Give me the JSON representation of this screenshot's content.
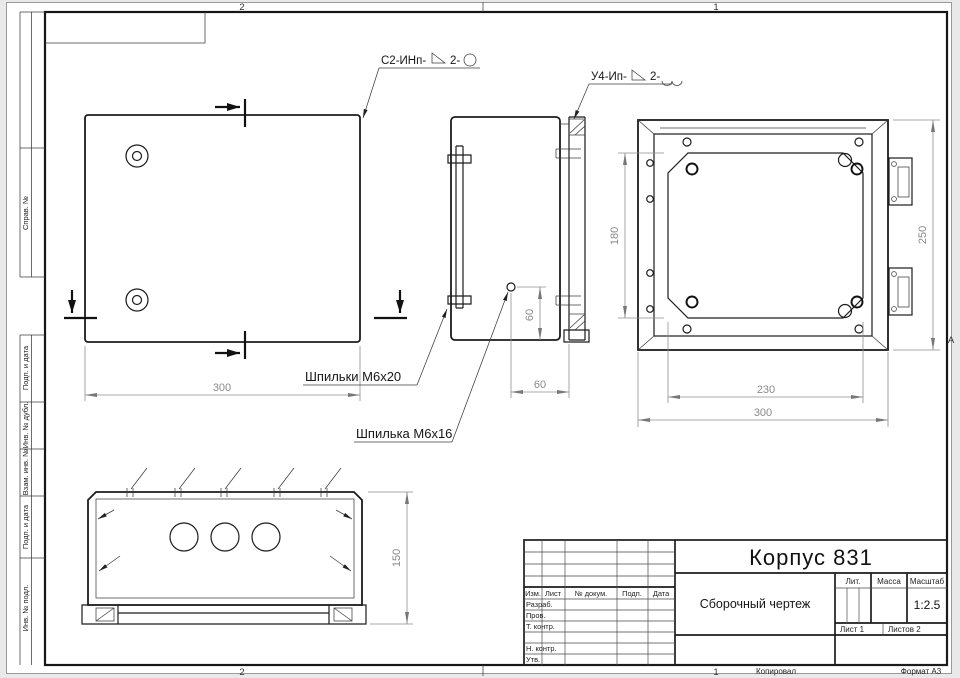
{
  "drawing": {
    "callout_weld_1": {
      "prefix": "С2-ИНп-",
      "num": "2-"
    },
    "callout_weld_2": {
      "prefix": "У4-Ип-",
      "num": "2-"
    },
    "label_studs": "Шпильки М6х20",
    "label_stud": "Шпилька М6х16",
    "dims": {
      "front_width": "300",
      "stud_offset_v": "60",
      "stud_offset_h": "60",
      "rear_plate_height": "180",
      "rear_height": "250",
      "rear_plate_width": "230",
      "rear_width": "300",
      "depth": "150"
    },
    "zone_letter": "А"
  },
  "frame": {
    "zones_top": [
      "2",
      "1"
    ],
    "zones_bottom": [
      "2",
      "1"
    ],
    "margin_upper": [
      "",
      "Справ. №"
    ],
    "margin_lower": [
      "Подп. и дата",
      "Инв. № дубл.",
      "Взам. инв. №",
      "Подп. и дата",
      "Инв. № подл."
    ],
    "footer": {
      "copied": "Копировал",
      "format": "Формат А3"
    }
  },
  "title_block": {
    "part_title": "Корпус 831",
    "doc_type": "Сборочный чертеж",
    "scale": "1:2.5",
    "col_izm": "Изм.",
    "col_list": "Лист",
    "col_doc": "№ докум.",
    "col_podp": "Подп.",
    "col_data": "Дата",
    "row_razrab": "Разраб.",
    "row_prov": "Пров.",
    "row_tkontr": "Т. контр.",
    "row_nkontr": "Н. контр.",
    "row_utv": "Утв.",
    "lit": "Лит.",
    "massa": "Масса",
    "masshtab": "Масштаб",
    "sheet": "Лист 1",
    "sheets": "Листов 2"
  }
}
